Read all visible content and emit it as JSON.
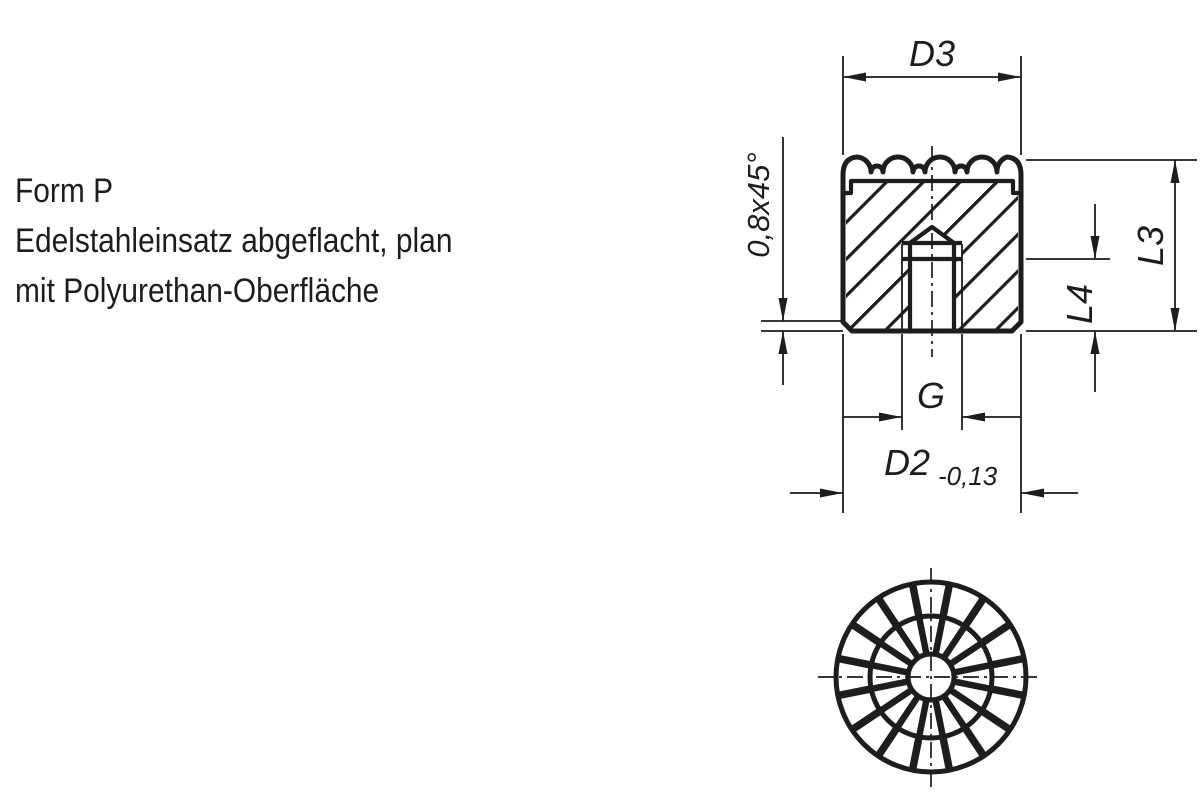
{
  "colors": {
    "ink": "#1d1d1b",
    "paper": "#ffffff"
  },
  "note": {
    "lines": [
      "Form P",
      "Edelstahleinsatz abgeflacht, plan",
      "mit Polyurethan-Oberfläche"
    ]
  },
  "section_view": {
    "dim_top_diameter": "D3",
    "dim_overall_height": "L3",
    "dim_thread_depth": "L4",
    "dim_thread": "G",
    "dim_body_diameter": "D2",
    "dim_body_diameter_tolerance": "-0,13",
    "dim_chamfer": "0,8x45°"
  }
}
